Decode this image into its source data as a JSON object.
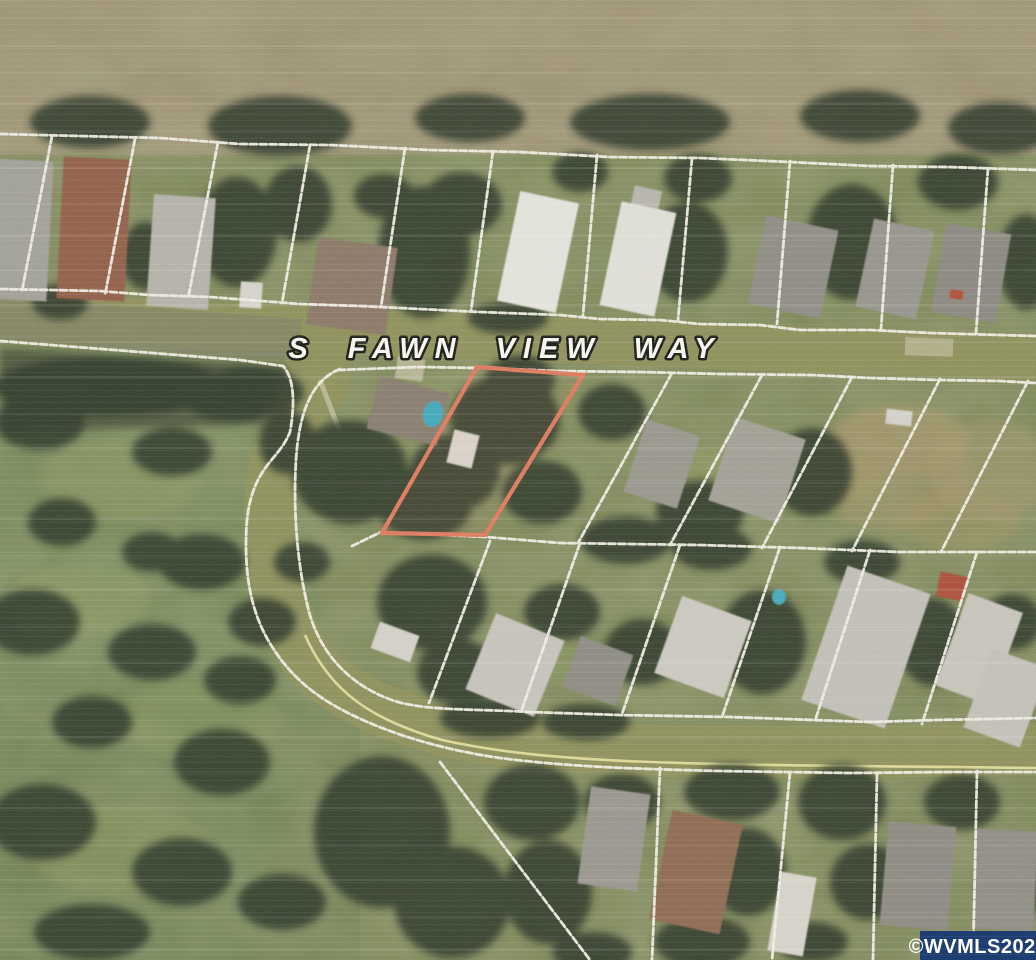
{
  "map": {
    "street_label": "S FAWN VIEW WAY",
    "watermark_text": "©WVMLS2024",
    "colors": {
      "highlight": "#e0795f",
      "parcel_line": "#f2f0e6",
      "watermark_bg": "#1e3e72",
      "watermark_text": "#ffffff",
      "road_edge_line": "#e8e3a2"
    }
  }
}
